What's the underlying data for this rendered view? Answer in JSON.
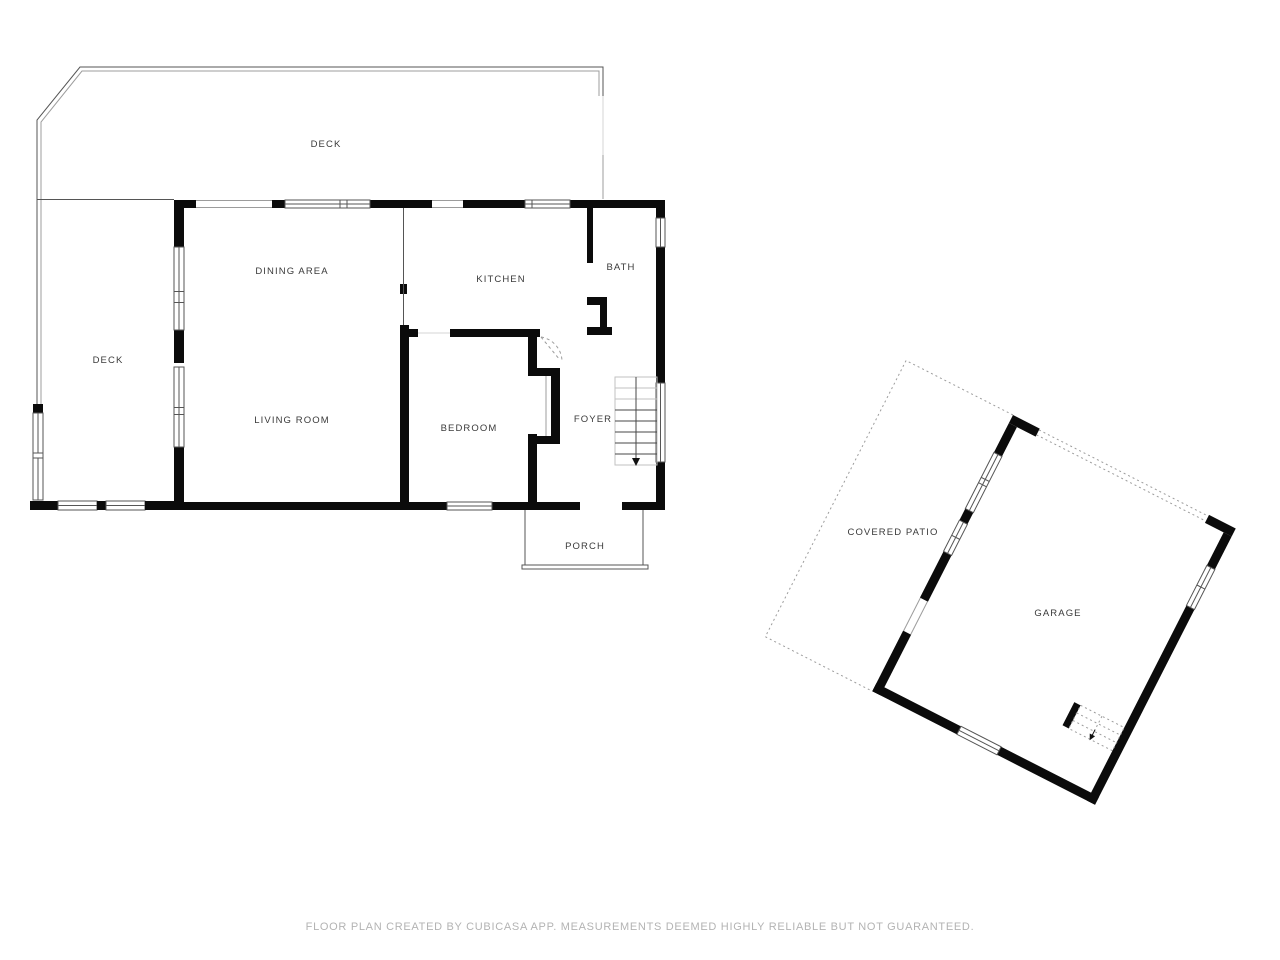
{
  "rooms": {
    "deck_top": "DECK",
    "deck_left": "DECK",
    "dining_area": "DINING AREA",
    "kitchen": "KITCHEN",
    "bath": "BATH",
    "living_room": "LIVING ROOM",
    "bedroom": "BEDROOM",
    "foyer": "FOYER",
    "porch": "PORCH",
    "covered_patio": "COVERED PATIO",
    "garage": "GARAGE"
  },
  "footer": {
    "disclaimer": "FLOOR PLAN CREATED BY CUBICASA APP. MEASUREMENTS DEEMED HIGHLY RELIABLE BUT NOT GUARANTEED."
  },
  "colors": {
    "wall": "#0b0b0b",
    "thin_line": "#555555",
    "light_line": "#9c9c9c",
    "label_text": "#3a3a3a",
    "footer_text": "#b3b3b3",
    "background": "#ffffff"
  }
}
